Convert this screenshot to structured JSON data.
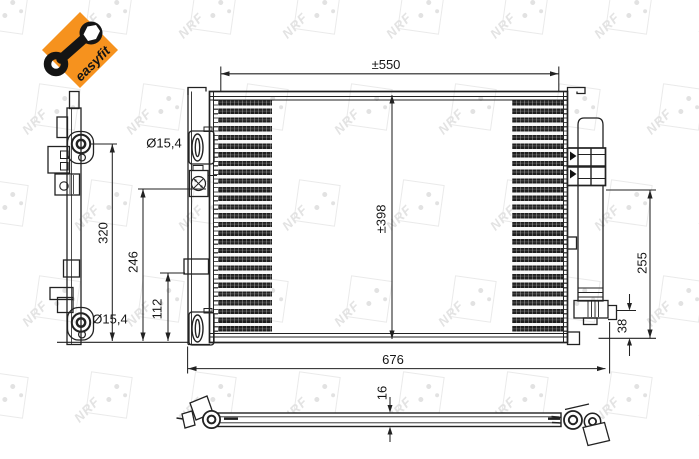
{
  "badge": {
    "label": "easyfit",
    "color": "#F6921E"
  },
  "watermark": {
    "text": "NRF"
  },
  "views": {
    "front": {
      "top_width_label": "±550",
      "core_height_label": "±398",
      "overall_width_label": "676",
      "top_port_diameter_label": "Ø15,4",
      "bottom_port_diameter_label": "Ø15,4"
    },
    "left_side": {
      "overall_height_label": "320",
      "upper_fitting_height_label": "246",
      "lower_fitting_height_label": "112"
    },
    "right_side": {
      "drier_height_label": "255",
      "bracket_height_label": "38"
    },
    "bottom": {
      "thickness_label": "16"
    }
  },
  "colors": {
    "accent_orange": "#F6921E",
    "line": "#222222",
    "watermark_gray": "#e3e3e3"
  }
}
